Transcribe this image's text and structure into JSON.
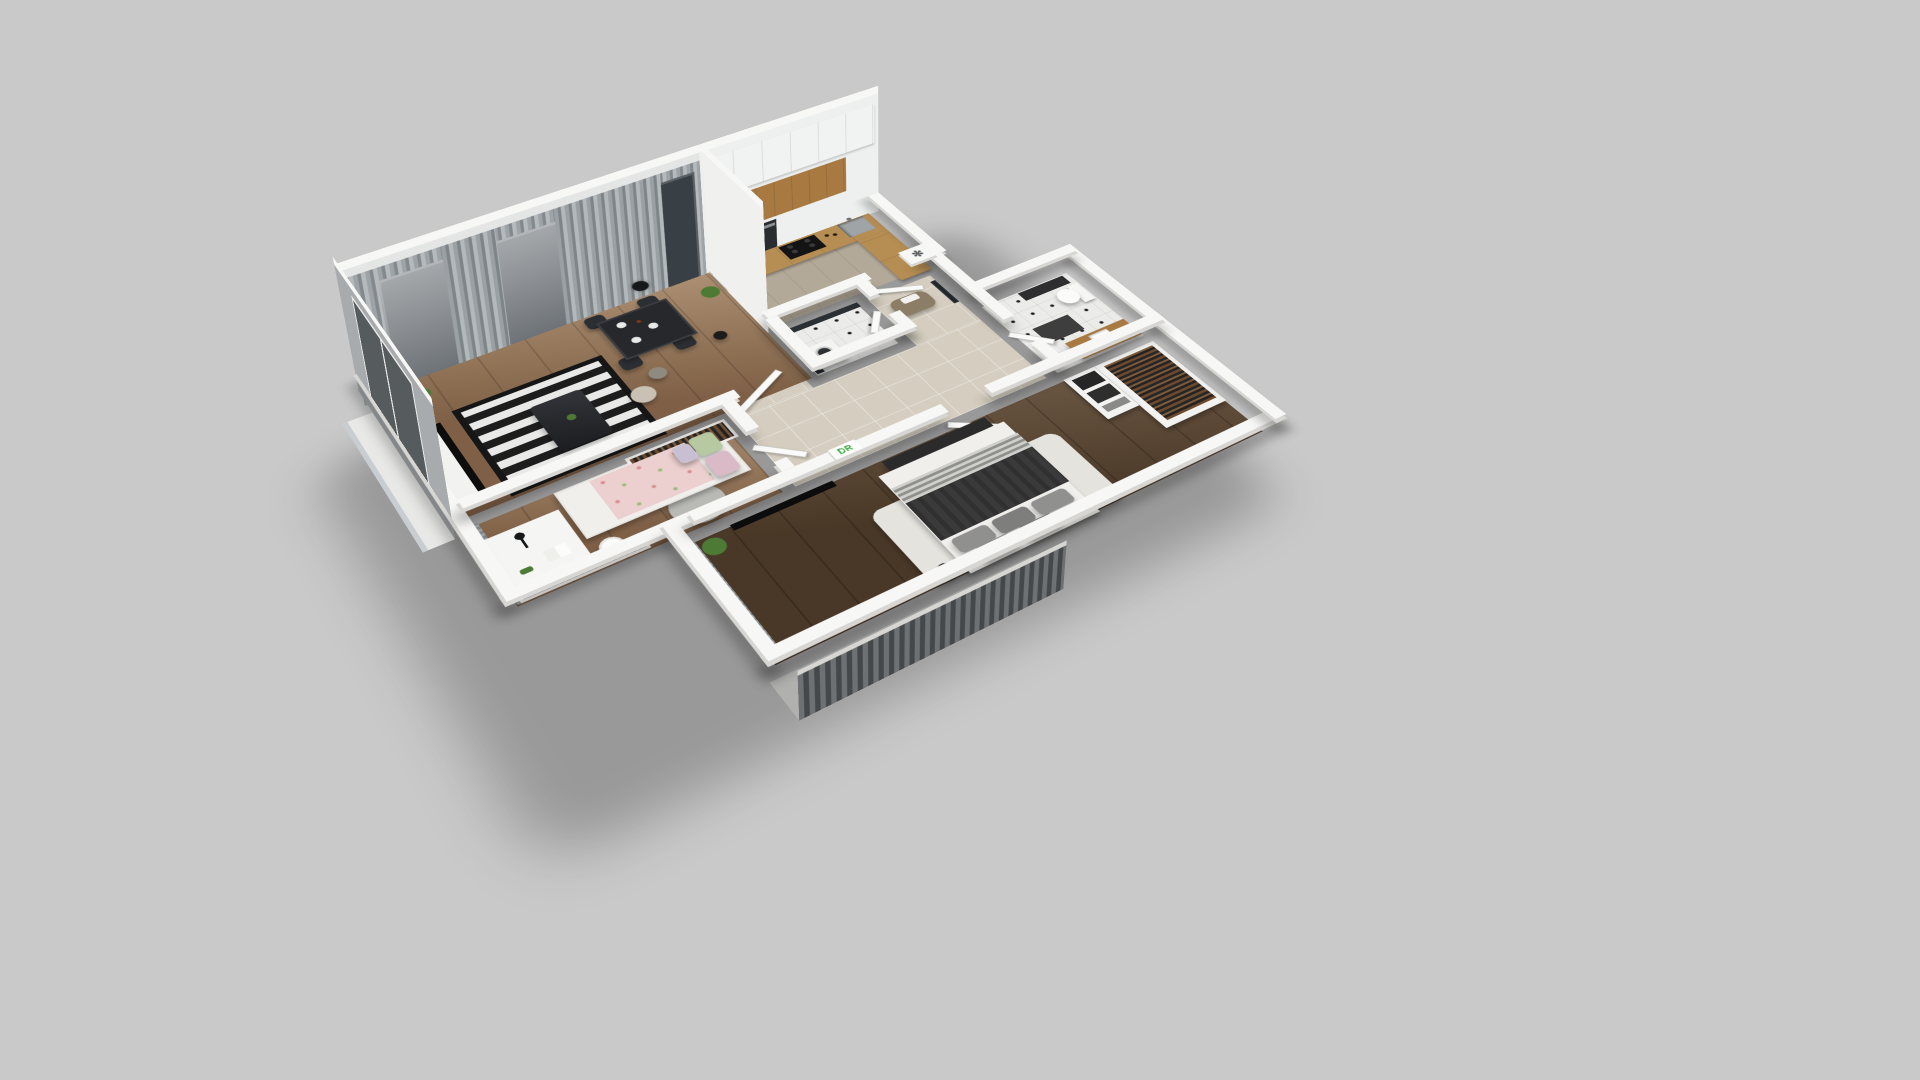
{
  "scene": {
    "name": "apartment-3d-floor-plan-render",
    "style": "axonometric cutaway dollhouse view",
    "background": "#c9c9c9"
  },
  "decor": {
    "wall_letters": "DR",
    "vent_symbol": "✻"
  },
  "rooms": [
    {
      "name": "living-dining-room",
      "floor": "wood",
      "furniture": [
        "tv-console",
        "tv",
        "striped-rug",
        "coffee-table",
        "dining-table",
        "dining-chairs",
        "pendant-lamp",
        "floor-lamp",
        "poufs",
        "plants",
        "curtain-wall-windows"
      ]
    },
    {
      "name": "kitchen",
      "floor": "gray-wood",
      "furniture": [
        "upper-cabinets",
        "wood-backsplash",
        "oven",
        "cooktop",
        "sink",
        "l-counter"
      ]
    },
    {
      "name": "laundry-wc",
      "floor": "tile-dots",
      "furniture": [
        "washing-machine",
        "dark-accent-walls"
      ]
    },
    {
      "name": "entry-hall",
      "floor": "beige-tile",
      "furniture": [
        "bench",
        "mirror",
        "vent-plate"
      ]
    },
    {
      "name": "hallway",
      "floor": "beige-tile",
      "furniture": [
        "doors"
      ]
    },
    {
      "name": "kids-room",
      "floor": "wood",
      "furniture": [
        "bed-pink",
        "pillows",
        "desk",
        "desk-lamp",
        "book",
        "toy-dinosaur",
        "chair",
        "round-rug",
        "wardrobe-hanging-clothes",
        "curtains"
      ]
    },
    {
      "name": "bedroom",
      "floor": "dark-wood",
      "furniture": [
        "double-bed",
        "gray-pillows",
        "dark-blanket",
        "shag-rug",
        "side-table",
        "wall-tv",
        "decor-letters",
        "plant",
        "wardrobe-hanging-clothes",
        "black-boxes",
        "foot-bench"
      ]
    },
    {
      "name": "bathroom",
      "floor": "tile-dots",
      "furniture": [
        "toilet",
        "wood-vanity",
        "sink",
        "dark-mat",
        "wall-shelf"
      ]
    },
    {
      "name": "balcony-west",
      "floor": "white",
      "furniture": [
        "glass-railing"
      ]
    },
    {
      "name": "balcony-south",
      "floor": "gray",
      "furniture": [
        "louver-screen",
        "floor-lamp"
      ]
    }
  ],
  "colors": {
    "bg": "#c9c9c9",
    "wallTop": "#f7f7f5",
    "wallSide": "#d7d6d3",
    "wallFace": "#e4e6e6",
    "accentWall": "#a7abad",
    "curtainA": "#9aa0a4",
    "curtainB": "#7e8589",
    "curtainC": "#b3b8bb",
    "windowGlass": "#383f45",
    "woodFloor": "#8d6b4e",
    "woodDark": "#57422e",
    "kitchenFloor": "#b3a998",
    "beigeFloor": "#d5cec0",
    "tileFloor": "#ebebe9",
    "tileDot": "#1d1d1d",
    "darkWallWC": "#2b3035",
    "counterWood": "#b68d52",
    "backsplashWood": "#a87a42",
    "cabinetWhite": "#eef0f0",
    "black": "#141414",
    "rugDark": "#1d1d1d",
    "rugLight": "#e9e9e7",
    "shagRug": "#e5e3de",
    "mattress": "#f0efeb",
    "blanketDark": "#3a3a3a",
    "pillowGray": "#90908e",
    "runnerLight": "#cfcfcc",
    "pinkBlanket": "#eccfcf",
    "pillowGreen": "#b7c9a0",
    "pillowPink": "#d9bac6",
    "pillowLilac": "#c9bfd2",
    "benchTaupe": "#8c7e66",
    "plantGreen": "#4d7a35",
    "clothesA": "#6b4a2f",
    "clothesB": "#27221f",
    "clothesC": "#7d5d3e",
    "glassRail": "#c7cdd0",
    "louverA": "#6e7173",
    "louverB": "#45484a",
    "doorWhite": "#fafafa",
    "steel": "#9fa4a6",
    "decorGreen": "#3fae49"
  }
}
